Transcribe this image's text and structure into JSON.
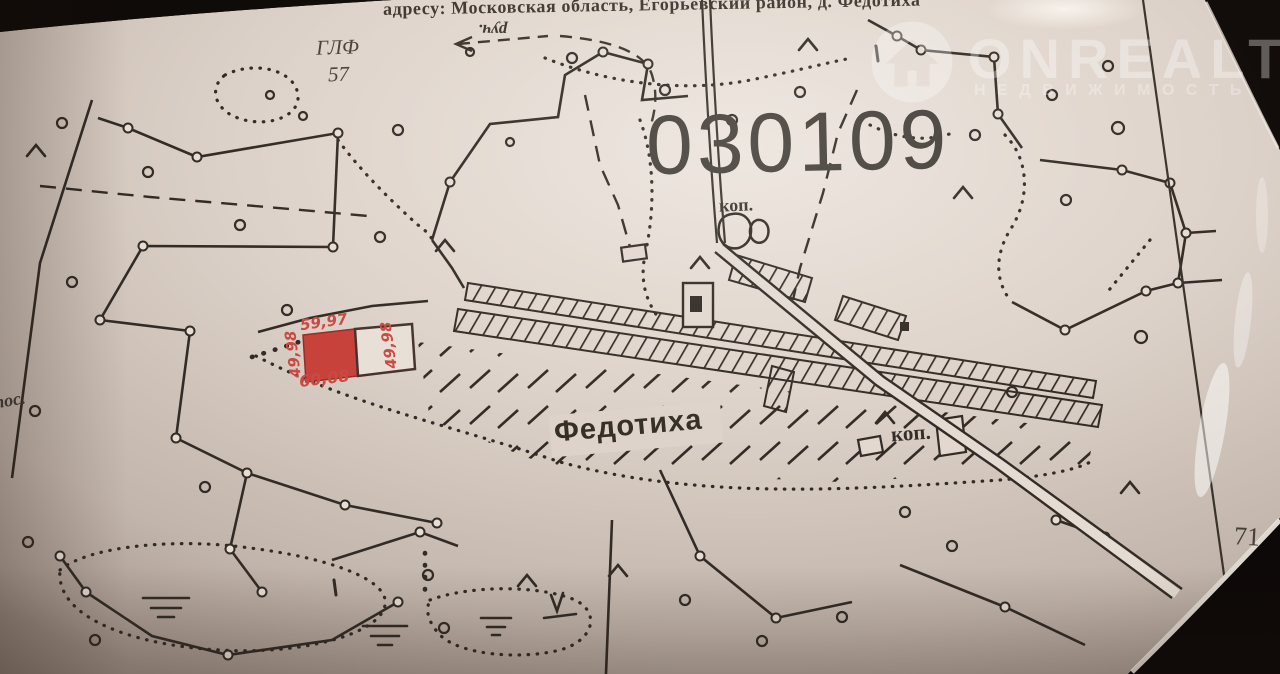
{
  "photo": {
    "header_text": "адресу: Московская область, Егорьевский район, д. Федотиха",
    "watermark": {
      "brand": "ONREALT",
      "subtitle": "НЕДВИЖИМОСТЬ",
      "icon": "house-in-circle",
      "color": "#ffffff"
    }
  },
  "map": {
    "quarter_number": "030109",
    "village_name": "Федотиха",
    "forest_block": {
      "abbr": "ГЛФ",
      "number": "57"
    },
    "stream_label": "руч.",
    "pond_labels": [
      "коп.",
      "коп."
    ],
    "settlement_label": "пос.",
    "grid_number": "71",
    "plot_dimensions": {
      "top": "59,97",
      "bottom": "60,08",
      "left": "49,98",
      "right": "49,98"
    },
    "colors": {
      "ink": "#332c26",
      "paper": "#ddd2c9",
      "plot_fill": "#c8423c",
      "plot_label": "#c94a42"
    }
  }
}
